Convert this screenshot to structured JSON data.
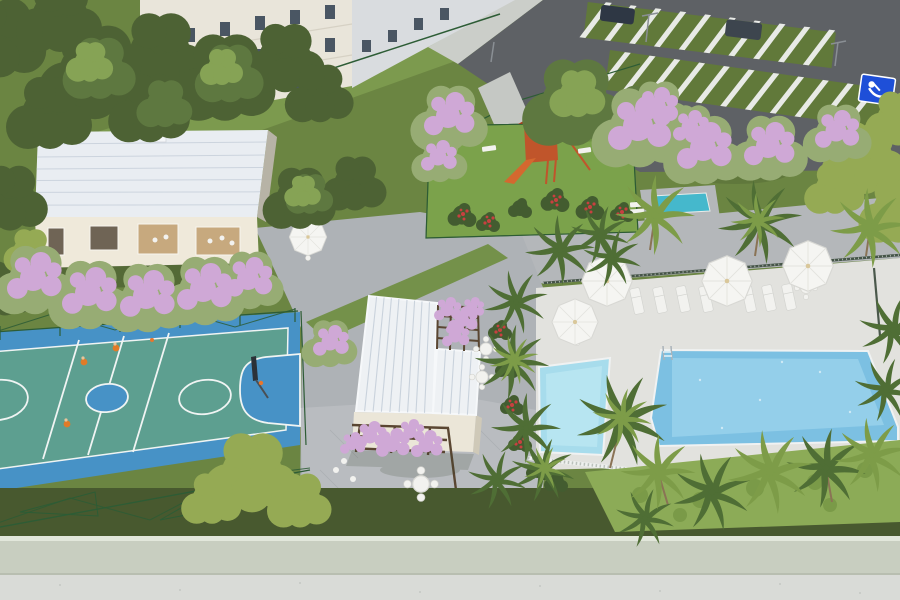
{
  "scene": {
    "title": "Aerial 3D rendering of a residential condominium leisure area",
    "objects": {
      "apartment_buildings": "apartment facades with window grid (top left)",
      "parking_lot": "permeable parking stalls, two striped rows (top right)",
      "accessible_space": "blue wheelchair parking marking",
      "party_hall": "party hall building with pale ribbed metal roof (left)",
      "sports_court": "blue and teal multi-sport court with hoop and players (bottom left)",
      "playground": "red timber playground on bright turf (top center)",
      "gourmet_pavilion": "white ribbed-roof pavilion with bougainvillea pergolas (center)",
      "main_pool": "large rectangular swimming pool (right)",
      "kids_pool": "small children's pool beside pavilion",
      "pool_deck": "light deck with white umbrellas, tables and sun loungers",
      "umbrella_count": 5,
      "sun_lounger_count": 7,
      "palm_trees": "palms along walkway, pool and bottom hedge",
      "flowering_trees": "pink flowering trees by buildings and parking",
      "perimeter_wall": "sage perimeter wall with outer sidewalk (bottom)"
    }
  },
  "colors": {
    "grass_base": "#6b8542",
    "grass_band": "#7c9a4e",
    "grass_dark": "#48592f",
    "turf": "#7ba24b",
    "grass_strip": "#74914a",
    "bush_strip": "#8cab57",
    "bush_strip_dark": "#7a9a48",
    "tree_dark": "#4d6234",
    "tree_mid": "#5e7840",
    "tree_light": "#86a355",
    "tree_yellow": "#95aa54",
    "pink_base": "#97ac74",
    "pink_bloom": "#cfa8d6",
    "palm_dark": "#4f6e35",
    "palm_light": "#7d9c48",
    "trunk": "#8a7355",
    "red_flower": "#c84040",
    "bush_dark": "#435c30",
    "court_blue": "#4792c6",
    "court_teal": "#5d9f90",
    "court_line": "#f0f4f3",
    "fence_green": "#2d5c35",
    "asphalt": "#5e6165",
    "sidewalk_top": "#cbcec9",
    "path_gray": "#c5c8c4",
    "paver_plaza": "#aeb2b6",
    "paver_walkway": "#b4b7ba",
    "paver_patio": "#b9bcc0",
    "paver_line": "#a5a9ad",
    "deck": "#e2e2de",
    "pool_water": "#7cc0e2",
    "pool_light": "#9ad2ec",
    "kids_water": "#a7dcec",
    "kids_light": "#bce7f2",
    "lap_water": "#45b8cc",
    "coping": "#f0f2f2",
    "roof_white": "#eef1f4",
    "roof_rib": "#c9d2dc",
    "roof_left": "#e9edf2",
    "roof_left_rib": "#ccd4de",
    "facade_cream": "#e9e5da",
    "facade_gray": "#d9dcdf",
    "window_dark": "#4a5663",
    "window_light": "#94a3b0",
    "hall_wall": "#efe9da",
    "hall_side": "#b7b3a6",
    "opening_dark": "#6f6455",
    "interior_warm": "#c7a97e",
    "club_wall": "#ebe6d8",
    "club_side": "#cfc9b8",
    "pergola_brown": "#5a4632",
    "umbrella_white": "#f5f5f2",
    "furniture_white": "#f2f2ef",
    "furniture_stroke": "#d3d4d0",
    "wall_sage": "#c8cec0",
    "wall_top": "#e2e7db",
    "sidewalk_bottom": "#d9dbd7",
    "handicap_blue": "#1e4fd8",
    "stall_grass": "#61793a",
    "stripe_white": "#e8eae6",
    "car_dark": "#2e3744",
    "car_dark2": "#3d454e",
    "lamp_gray": "#8a8f94",
    "player_orange": "#e07b28",
    "rim_orange": "#e8762c",
    "play_red": "#c0552b",
    "play_red_dark": "#a93d1c",
    "play_slide": "#d4682f",
    "dark_fence": "#3a4a3c",
    "picket_white": "#eef0ee",
    "picket_gap": "#9aa19a",
    "shadow": "#2c3a20"
  }
}
